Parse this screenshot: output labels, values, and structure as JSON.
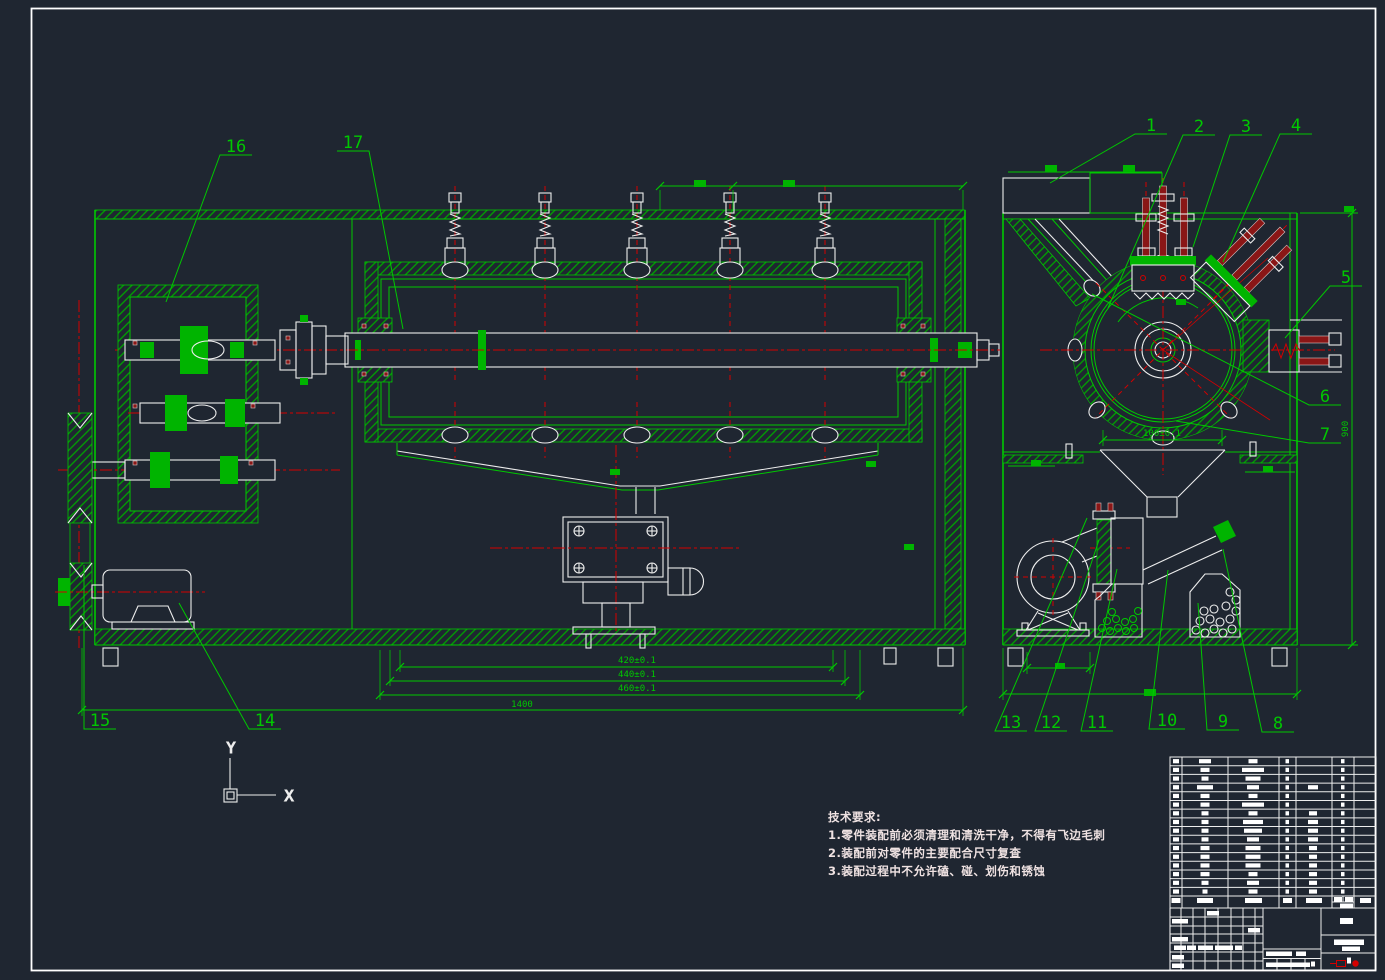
{
  "drawing": {
    "callouts": [
      {
        "label": "1"
      },
      {
        "label": "2"
      },
      {
        "label": "3"
      },
      {
        "label": "4"
      },
      {
        "label": "5"
      },
      {
        "label": "6"
      },
      {
        "label": "7"
      },
      {
        "label": "8"
      },
      {
        "label": "9"
      },
      {
        "label": "10"
      },
      {
        "label": "11"
      },
      {
        "label": "12"
      },
      {
        "label": "13"
      },
      {
        "label": "14"
      },
      {
        "label": "15"
      },
      {
        "label": "16"
      },
      {
        "label": "17"
      }
    ],
    "dimensions": {
      "chain": [
        "420±0.1",
        "440±0.1",
        "460±0.1"
      ],
      "overall_length": "1400",
      "funnel_opening": "100±0.1",
      "overall_height": "900"
    },
    "tech_requirements": {
      "title": "技术要求:",
      "items": [
        "1.零件装配前必须清理和清洗干净，不得有飞边毛刺",
        "2.装配前对零件的主要配合尺寸复查",
        "3.装配过程中不允许磕、碰、划伤和锈蚀"
      ]
    },
    "ucs": {
      "x_label": "X",
      "y_label": "Y"
    },
    "colors": {
      "background": "#1F2631",
      "line_green": "#00C800",
      "fill_green": "#00B400",
      "centerline_red": "#D40000",
      "bolt_maroon": "#8A1616",
      "line_white": "#FFFFFF"
    }
  }
}
